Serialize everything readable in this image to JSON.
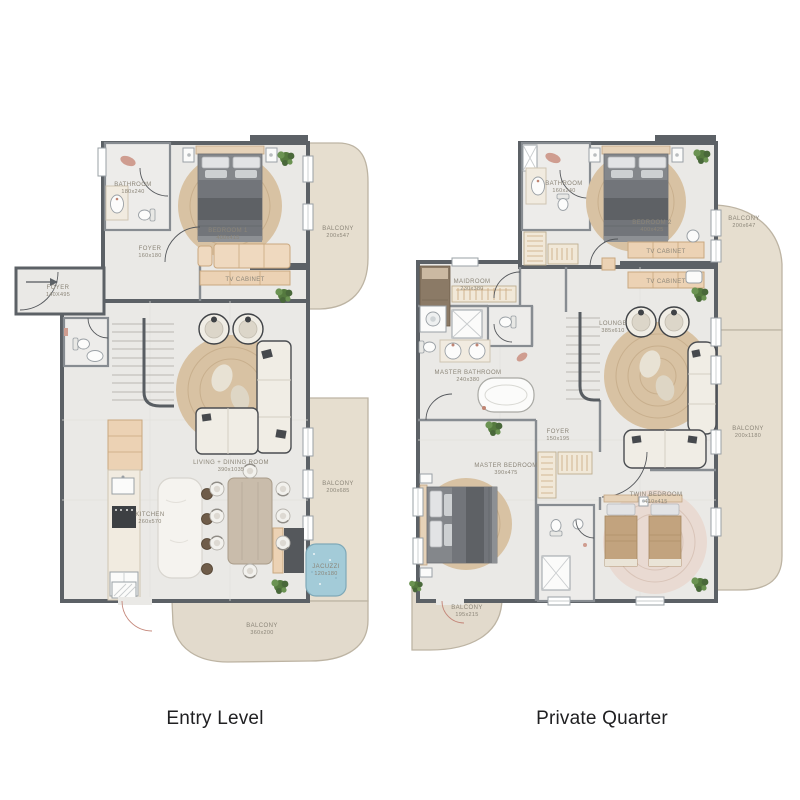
{
  "colors": {
    "wall": "#5c6166",
    "floor": "#eae9e6",
    "balcony": "#e6decf",
    "wood": "#ecd2b4",
    "jacuzzi": "#a3cbd8",
    "plant": "#55793f",
    "label_text": "#8b8578",
    "title_text": "#202022"
  },
  "plans": [
    {
      "id": "entry-level",
      "title": "Entry Level",
      "rooms": [
        {
          "name": "BATHROOM",
          "dims": "180x240"
        },
        {
          "name": "FOYER",
          "dims": "160x180"
        },
        {
          "name": "BEDROOM 1",
          "dims": "400x415"
        },
        {
          "name": "TV CABINET",
          "dims": ""
        },
        {
          "name": "BALCONY",
          "dims": "200x547"
        },
        {
          "name": "FOYER",
          "dims": "140X495"
        },
        {
          "name": "LIVING + DINING ROOM",
          "dims": "390x1035"
        },
        {
          "name": "KITCHEN",
          "dims": "260x570"
        },
        {
          "name": "BALCONY",
          "dims": "200x685"
        },
        {
          "name": "JACUZZI",
          "dims": "120x180"
        },
        {
          "name": "BALCONY",
          "dims": "360x200"
        }
      ]
    },
    {
      "id": "private-quarter",
      "title": "Private Quarter",
      "rooms": [
        {
          "name": "BATHROOM",
          "dims": "160x240"
        },
        {
          "name": "BEDROOM 2",
          "dims": "400x425"
        },
        {
          "name": "TV CABINET",
          "dims": ""
        },
        {
          "name": "TV CABINET",
          "dims": ""
        },
        {
          "name": "BALCONY",
          "dims": "200x647"
        },
        {
          "name": "MAIDROOM",
          "dims": "230x380"
        },
        {
          "name": "MASTER BATHROOM",
          "dims": "240x380"
        },
        {
          "name": "LOUNGE",
          "dims": "385x610"
        },
        {
          "name": "FOYER",
          "dims": "150x195"
        },
        {
          "name": "MASTER BEDROOM",
          "dims": "390x475"
        },
        {
          "name": "TWIN BEDROOM",
          "dims": "410x415"
        },
        {
          "name": "BALCONY",
          "dims": "195x215"
        },
        {
          "name": "BALCONY",
          "dims": "200x1180"
        }
      ]
    }
  ]
}
